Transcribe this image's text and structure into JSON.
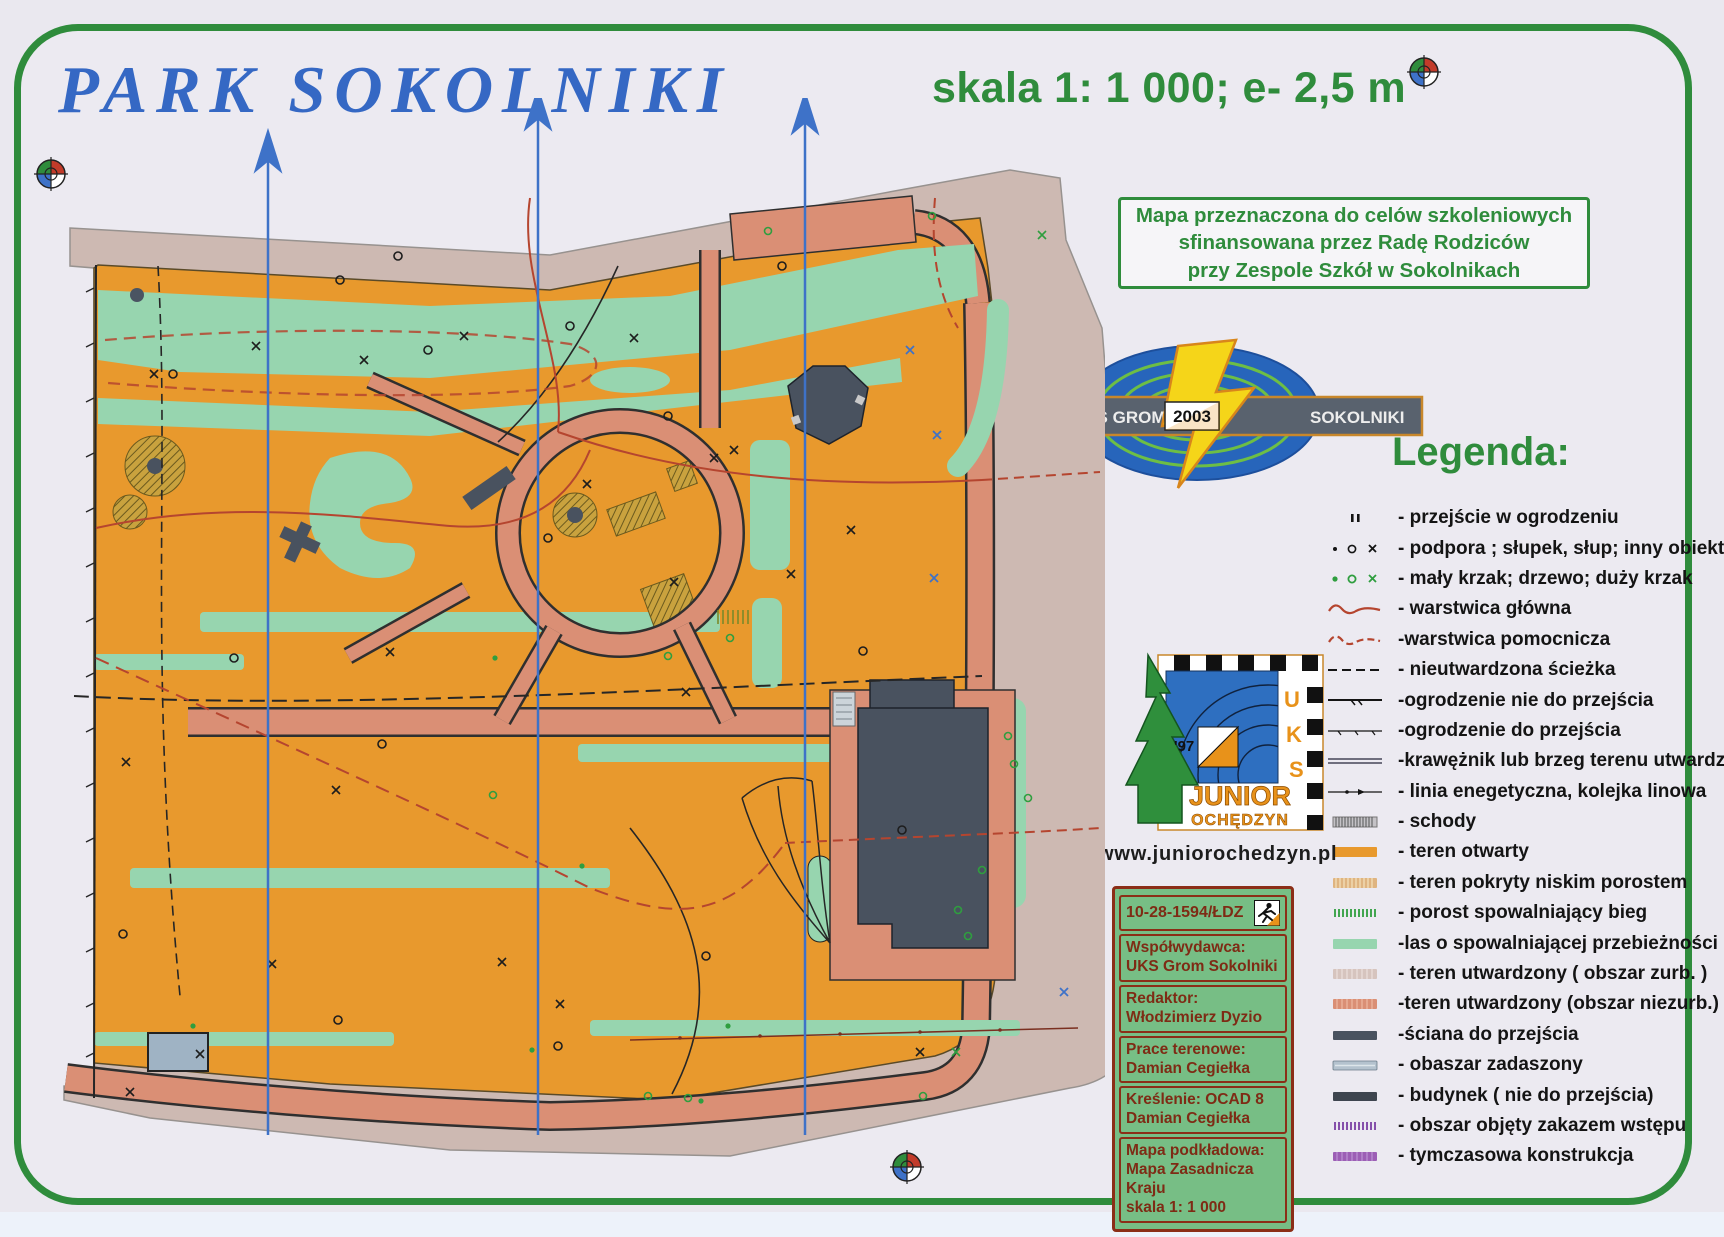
{
  "header": {
    "title": "PARK SOKOLNIKI",
    "scale_note": "skala 1: 1 000; e- 2,5 m"
  },
  "purpose_box": {
    "text": "Mapa przeznaczona do celów szkoleniowych\nsfinansowana przez Radę Rodziców\nprzy Zespole Szkół w Sokolnikach"
  },
  "grom_logo": {
    "left_text": "UKS GROM",
    "year": "2003",
    "right_text": "SOKOLNIKI"
  },
  "legend": {
    "heading": "Legenda:",
    "items": [
      {
        "symbol": "fence-gap",
        "label": "- przejście w ogrodzeniu"
      },
      {
        "symbol": "support-post-object",
        "label": "- podpora ; słupek, słup; inny obiekt"
      },
      {
        "symbol": "bush-tree-bigbush",
        "label": "- mały krzak; drzewo; duży krzak"
      },
      {
        "symbol": "contour-main",
        "label": "- warstwica główna"
      },
      {
        "symbol": "contour-auxiliary",
        "label": "-warstwica pomocnicza"
      },
      {
        "symbol": "unpaved-path",
        "label": "- nieutwardzona ścieżka"
      },
      {
        "symbol": "fence-impassable",
        "label": "-ogrodzenie nie do przejścia"
      },
      {
        "symbol": "fence-passable",
        "label": "-ogrodzenie do przejścia"
      },
      {
        "symbol": "curb-edge",
        "label": "-krawężnik lub brzeg terenu utwardz."
      },
      {
        "symbol": "power-line",
        "label": "- linia enegetyczna, kolejka linowa"
      },
      {
        "symbol": "stairs",
        "label": "- schody"
      },
      {
        "symbol": "open-terrain",
        "label": "- teren otwarty"
      },
      {
        "symbol": "low-vegetation",
        "label": "- teren pokryty niskim porostem"
      },
      {
        "symbol": "slowing-undergrowth",
        "label": "- porost spowalniający bieg"
      },
      {
        "symbol": "slow-forest",
        "label": "-las o spowalniającej przebieżności"
      },
      {
        "symbol": "paved-urban",
        "label": "- teren utwardzony ( obszar zurb. )"
      },
      {
        "symbol": "paved-nonurban",
        "label": "-teren utwardzony (obszar niezurb.)"
      },
      {
        "symbol": "passable-wall",
        "label": "-ściana do przejścia"
      },
      {
        "symbol": "canopy-area",
        "label": "- obaszar zadaszony"
      },
      {
        "symbol": "building",
        "label": "- budynek ( nie do przejścia)"
      },
      {
        "symbol": "forbidden-area",
        "label": "- obszar objęty zakazem wstępu"
      },
      {
        "symbol": "temporary-construction",
        "label": "- tymczasowa konstrukcja"
      }
    ]
  },
  "junior_logo": {
    "year": "'97",
    "letters": [
      "U",
      "K",
      "S"
    ],
    "name_line1": "JUNIOR",
    "name_line2": "OCHĘDZYN",
    "url": "www.juniorochedzyn.pl"
  },
  "credits": {
    "map_id": "10-28-1594/ŁDZ",
    "cells": [
      "Współwydawca:\nUKS Grom Sokolniki",
      "Redaktor:\nWłodzimierz Dyzio",
      "Prace terenowe:\nDamian Cegiełka",
      "Kreślenie: OCAD 8\nDamian Cegiełka",
      "Mapa podkładowa:\nMapa Zasadnicza Kraju\nskala 1: 1 000"
    ]
  },
  "colors": {
    "frame_green": "#2F8C3C",
    "title_blue": "#3568C4",
    "open_terrain": "#E8992D",
    "slow_forest": "#97D5AF",
    "paved_urban": "#CDB9B2",
    "paved_nonurban": "#DA8F75",
    "building": "#49525F",
    "north_line_blue": "#3E72C8",
    "contour_red": "#B5452F"
  }
}
